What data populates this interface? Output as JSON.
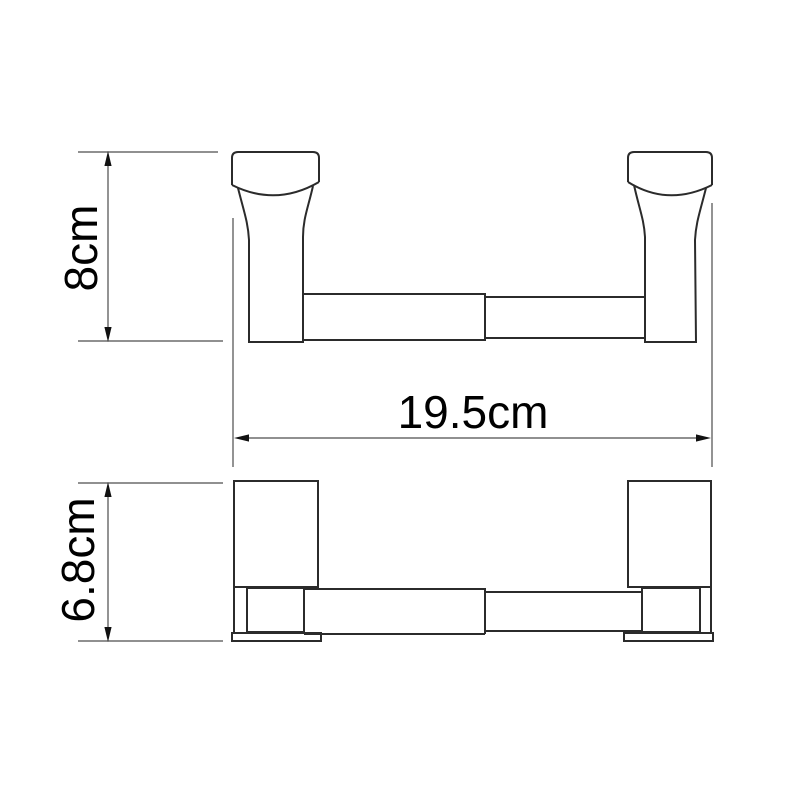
{
  "drawing": {
    "labels": {
      "height": "8cm",
      "width": "19.5cm",
      "depth": "6.8cm"
    },
    "values": {
      "height_cm": 8,
      "width_cm": 19.5,
      "depth_cm": 6.8
    },
    "colors": {
      "background": "#ffffff",
      "object_line": "#2b2b2b",
      "dimension_line": "#808080",
      "arrowhead": "#111111",
      "label_text": "#000000"
    }
  }
}
